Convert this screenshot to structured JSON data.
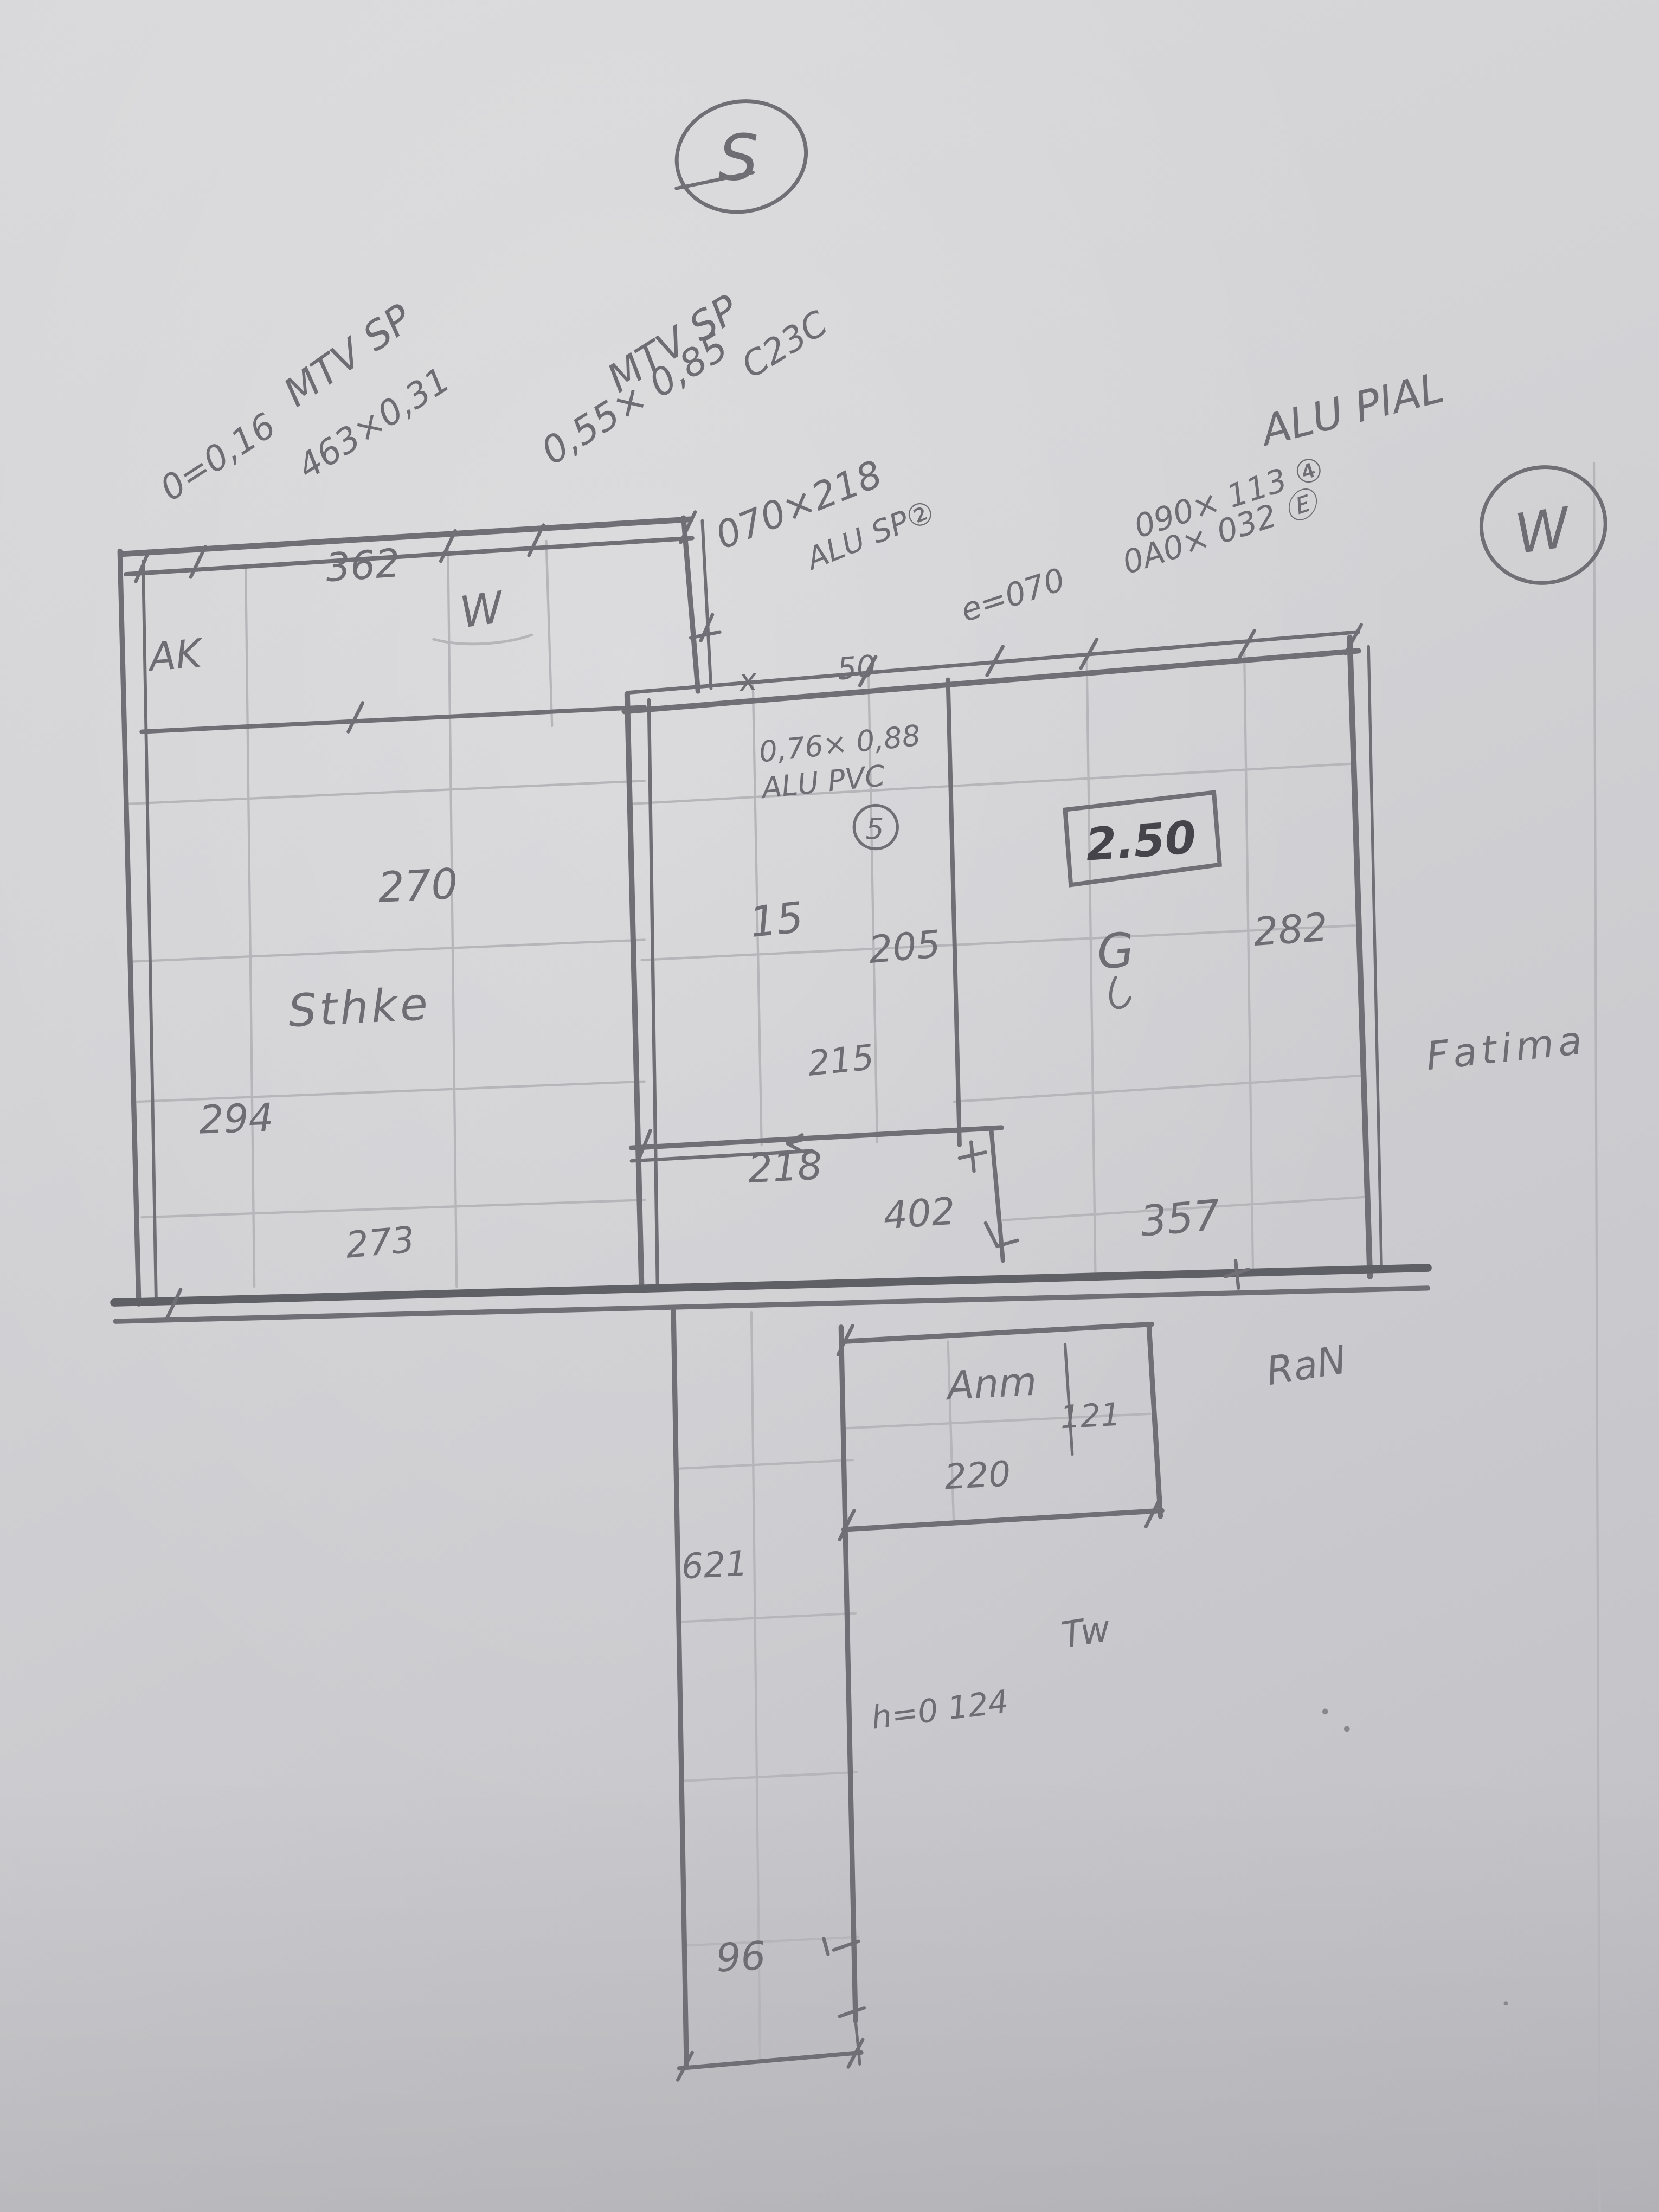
{
  "page": {
    "description_colors": {
      "paper": "#d3d3d6",
      "pencil": "#6f6f75",
      "pencil_faint": "#b5b5ba",
      "pencil_dark": "#44444a"
    }
  },
  "compass": {
    "south": "S",
    "west": "W"
  },
  "specs": {
    "spec1": {
      "title": "MTV SP",
      "line1": "0=0,16",
      "line2": "463×0,31"
    },
    "spec2": {
      "title": "MTV SP",
      "code": "C23C",
      "size": "0,55× 0,85"
    },
    "spec3": {
      "size": "070×218",
      "title": "ALU SP②",
      "note": "e=070"
    },
    "spec4": {
      "title": "ALU PIAL",
      "line1": "090× 113 ④",
      "line2": "0A0× 032 Ⓔ"
    },
    "spec5": {
      "size": "0,76× 0,88",
      "title": "ALU PVC",
      "num": "5"
    }
  },
  "rooms": {
    "ak": "AK",
    "w_note": "W",
    "sthke": "Sthke",
    "anm": "Anm",
    "g": "G",
    "owner": "Fatima",
    "ran": "RaN",
    "tw": "Tw"
  },
  "dims": {
    "d362": "362",
    "d270": "270",
    "d15": "15",
    "d205": "205",
    "d282": "282",
    "d215": "215",
    "d294": "294",
    "d218": "218",
    "d402": "402",
    "d357": "357",
    "d273": "273",
    "d121": "121",
    "d220": "220",
    "d621": "621",
    "d96": "96",
    "height_boxed": "2.50",
    "mark_x": "x",
    "mark_50": "50",
    "note_h": "h=0 124"
  }
}
